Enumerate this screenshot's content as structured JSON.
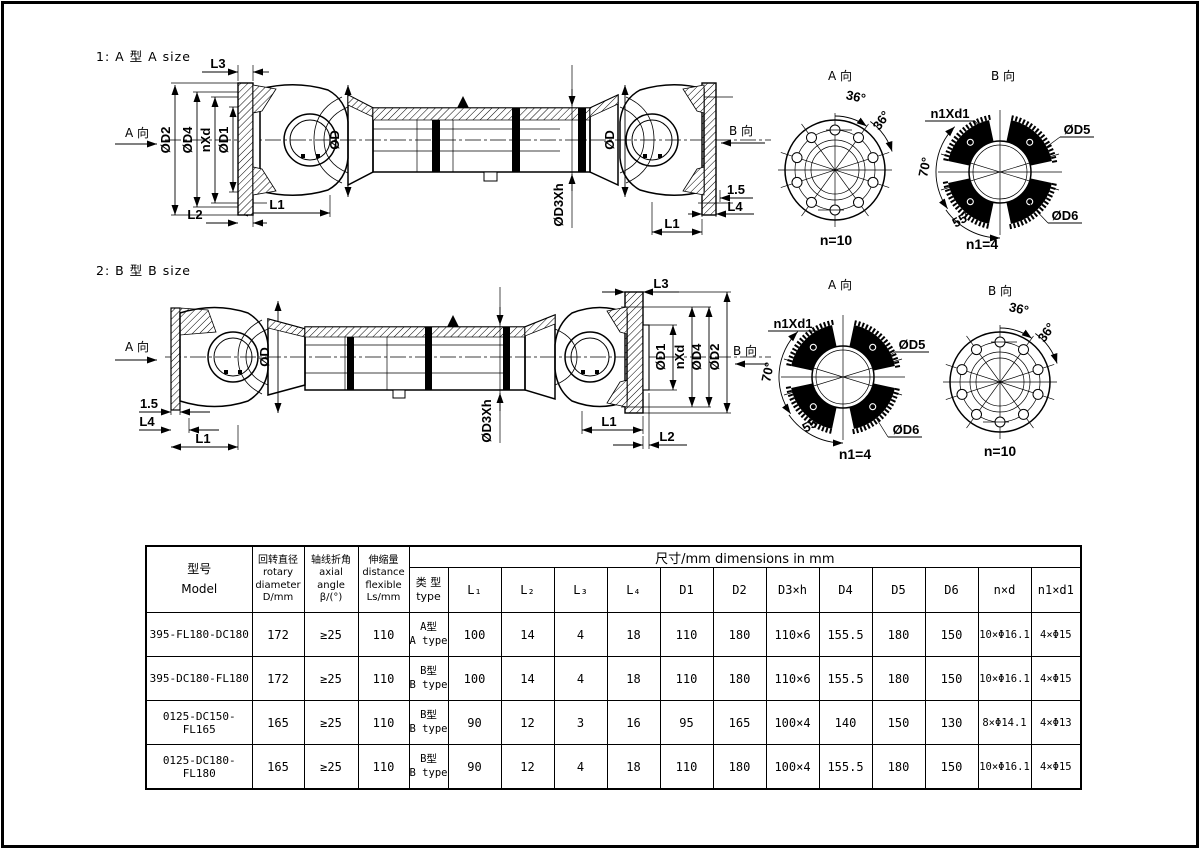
{
  "page": {
    "background": "#ffffff",
    "ink": "#000000"
  },
  "titles": {
    "section_a": "1: A 型 A size",
    "section_b": "2: B 型 B size"
  },
  "labels": {
    "a_dir": "A 向",
    "b_dir": "B 向",
    "l1": "L1",
    "l2": "L2",
    "l3": "L3",
    "l4": "L4",
    "od": "ØD",
    "od1": "ØD1",
    "od2": "ØD2",
    "od4": "ØD4",
    "od5": "ØD5",
    "od6": "ØD6",
    "od3h": "ØD3Xh",
    "nxd": "nXd",
    "n1xd1": "n1Xd1",
    "gap": "1.5",
    "n10": "n=10",
    "n14": "n1=4",
    "deg36": "36°",
    "deg70": "70°",
    "deg55": "55°"
  },
  "table": {
    "headers": {
      "model": "型号\nModel",
      "rotary": "回转直径\nrotary\ndiameter\nD/mm",
      "axial": "轴线折角\naxial\nangle\nβ/(°)",
      "flex": "伸缩量\ndistance\nflexible\nLs/mm",
      "banner": "尺寸/mm      dimensions in mm",
      "type": "类 型\ntype",
      "cols": [
        "L₁",
        "L₂",
        "L₃",
        "L₄",
        "D1",
        "D2",
        "D3×h",
        "D4",
        "D5",
        "D6",
        "n×d",
        "n1×d1"
      ]
    },
    "rows": [
      [
        "395-FL180-DC180",
        "172",
        "≥25",
        "110",
        "A型\nA type",
        "100",
        "14",
        "4",
        "18",
        "110",
        "180",
        "110×6",
        "155.5",
        "180",
        "150",
        "10×Φ16.1",
        "4×Φ15"
      ],
      [
        "395-DC180-FL180",
        "172",
        "≥25",
        "110",
        "B型\nB type",
        "100",
        "14",
        "4",
        "18",
        "110",
        "180",
        "110×6",
        "155.5",
        "180",
        "150",
        "10×Φ16.1",
        "4×Φ15"
      ],
      [
        "0125-DC150-FL165",
        "165",
        "≥25",
        "110",
        "B型\nB type",
        "90",
        "12",
        "3",
        "16",
        "95",
        "165",
        "100×4",
        "140",
        "150",
        "130",
        "8×Φ14.1",
        "4×Φ13"
      ],
      [
        "0125-DC180-FL180",
        "165",
        "≥25",
        "110",
        "B型\nB type",
        "90",
        "12",
        "4",
        "18",
        "110",
        "180",
        "100×4",
        "155.5",
        "180",
        "150",
        "10×Φ16.1",
        "4×Φ15"
      ]
    ]
  }
}
